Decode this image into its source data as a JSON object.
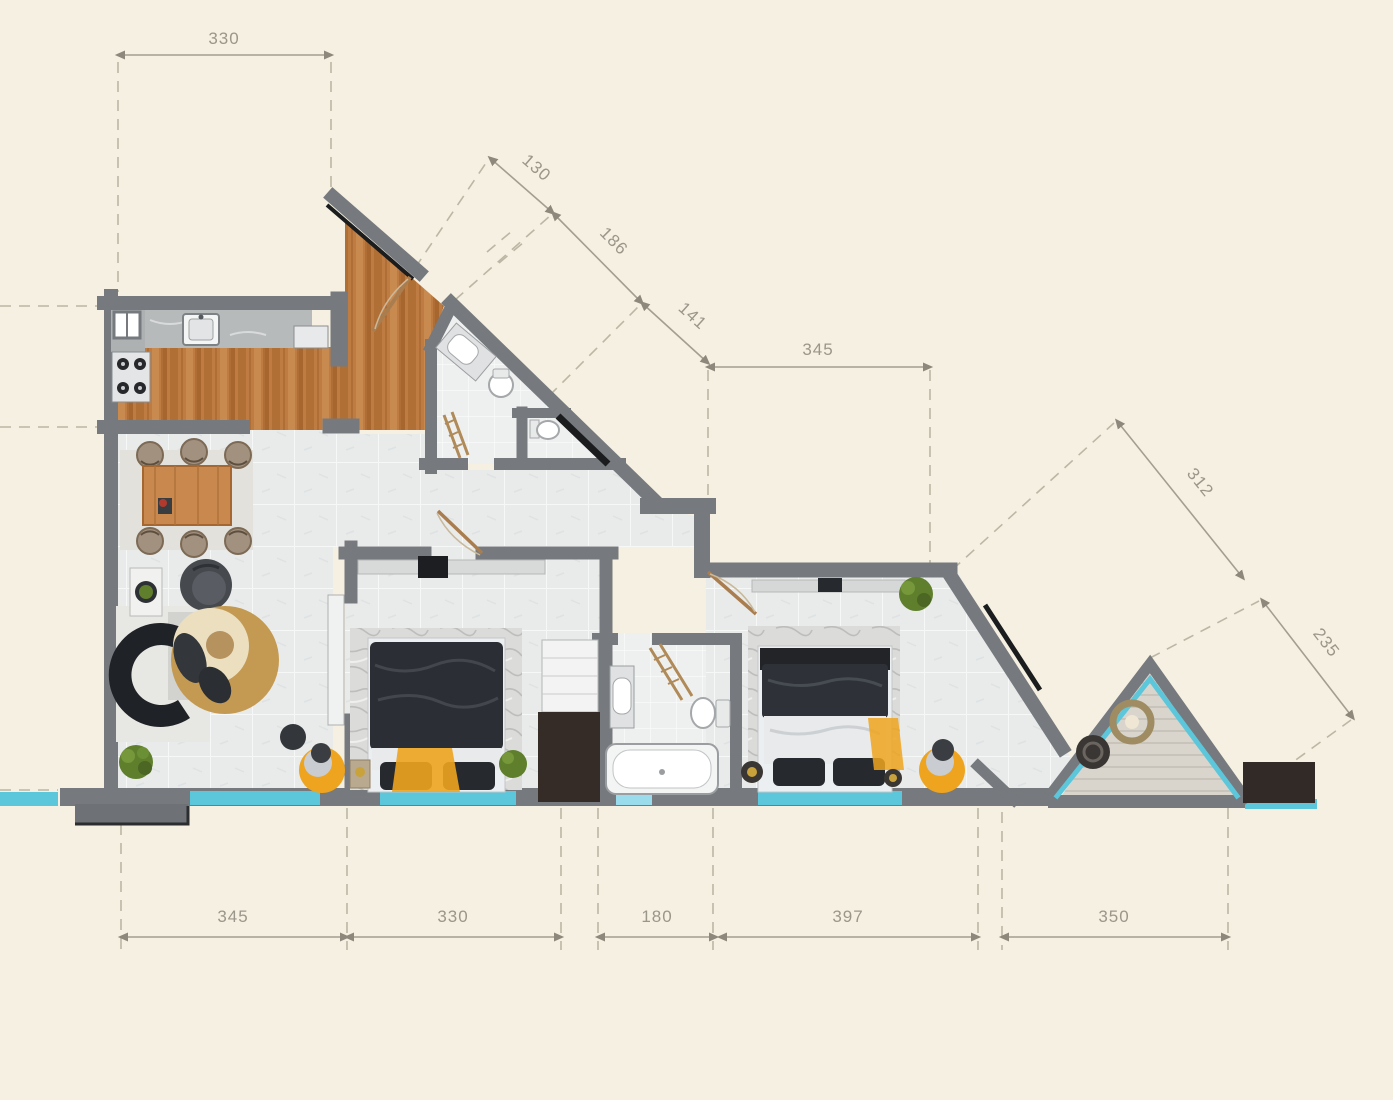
{
  "dimensions": {
    "top": "330",
    "diagonal_top": [
      "130",
      "186",
      "141"
    ],
    "upper_right": "345",
    "right_diagonal": [
      "312",
      "235"
    ],
    "bottom": [
      "345",
      "330",
      "180",
      "397",
      "350"
    ]
  },
  "palette": {
    "background": "#f5f0e1",
    "wall": "#76797d",
    "wall_shadow": "#1a1c1e",
    "window_glass": "#5cc6da",
    "window_glass_light": "#9adceb",
    "wood_floor": "#bf7c42",
    "tile_floor": "#e9ebeb",
    "accent_yellow": "#eea41f",
    "plant_green": "#5f7f2d",
    "dimension_text": "#9b968a"
  }
}
